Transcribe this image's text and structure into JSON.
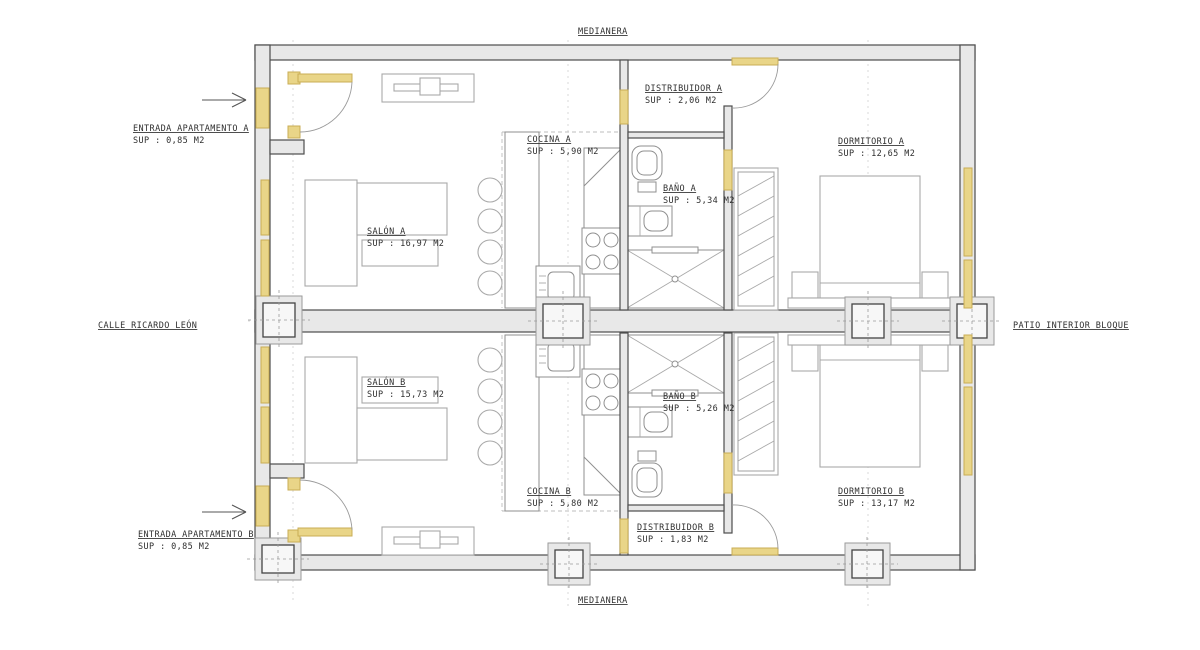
{
  "plan": {
    "boundaries": {
      "top": "MEDIANERA",
      "bottom": "MEDIANERA",
      "left": "CALLE RICARDO LEÓN",
      "right": "PATIO INTERIOR BLOQUE"
    },
    "entrances": {
      "a": {
        "label": "ENTRADA APARTAMENTO A",
        "area": "SUP : 0,85 M2"
      },
      "b": {
        "label": "ENTRADA APARTAMENTO B",
        "area": "SUP : 0,85 M2"
      }
    },
    "rooms": {
      "distribuidor_a": {
        "label": "DISTRIBUIDOR A",
        "area": "SUP : 2,06 M2"
      },
      "cocina_a": {
        "label": "COCINA A",
        "area": "SUP : 5,90 M2"
      },
      "bano_a": {
        "label": "BAÑO A",
        "area": "SUP : 5,34 M2"
      },
      "salon_a": {
        "label": "SALÓN A",
        "area": "SUP : 16,97 M2"
      },
      "dormitorio_a": {
        "label": "DORMITORIO A",
        "area": "SUP : 12,65 M2"
      },
      "salon_b": {
        "label": "SALÓN B",
        "area": "SUP : 15,73 M2"
      },
      "bano_b": {
        "label": "BAÑO B",
        "area": "SUP : 5,26 M2"
      },
      "cocina_b": {
        "label": "COCINA B",
        "area": "SUP : 5,80 M2"
      },
      "dormitorio_b": {
        "label": "DORMITORIO B",
        "area": "SUP : 13,17 M2"
      },
      "distribuidor_b": {
        "label": "DISTRIBUIDOR B",
        "area": "SUP : 1,83 M2"
      }
    },
    "colors": {
      "carpentry": "#e9d588",
      "wall_fill": "#e8e8e8",
      "wall_line": "#4d4d4d",
      "furniture_line": "#a9a9a9"
    }
  }
}
